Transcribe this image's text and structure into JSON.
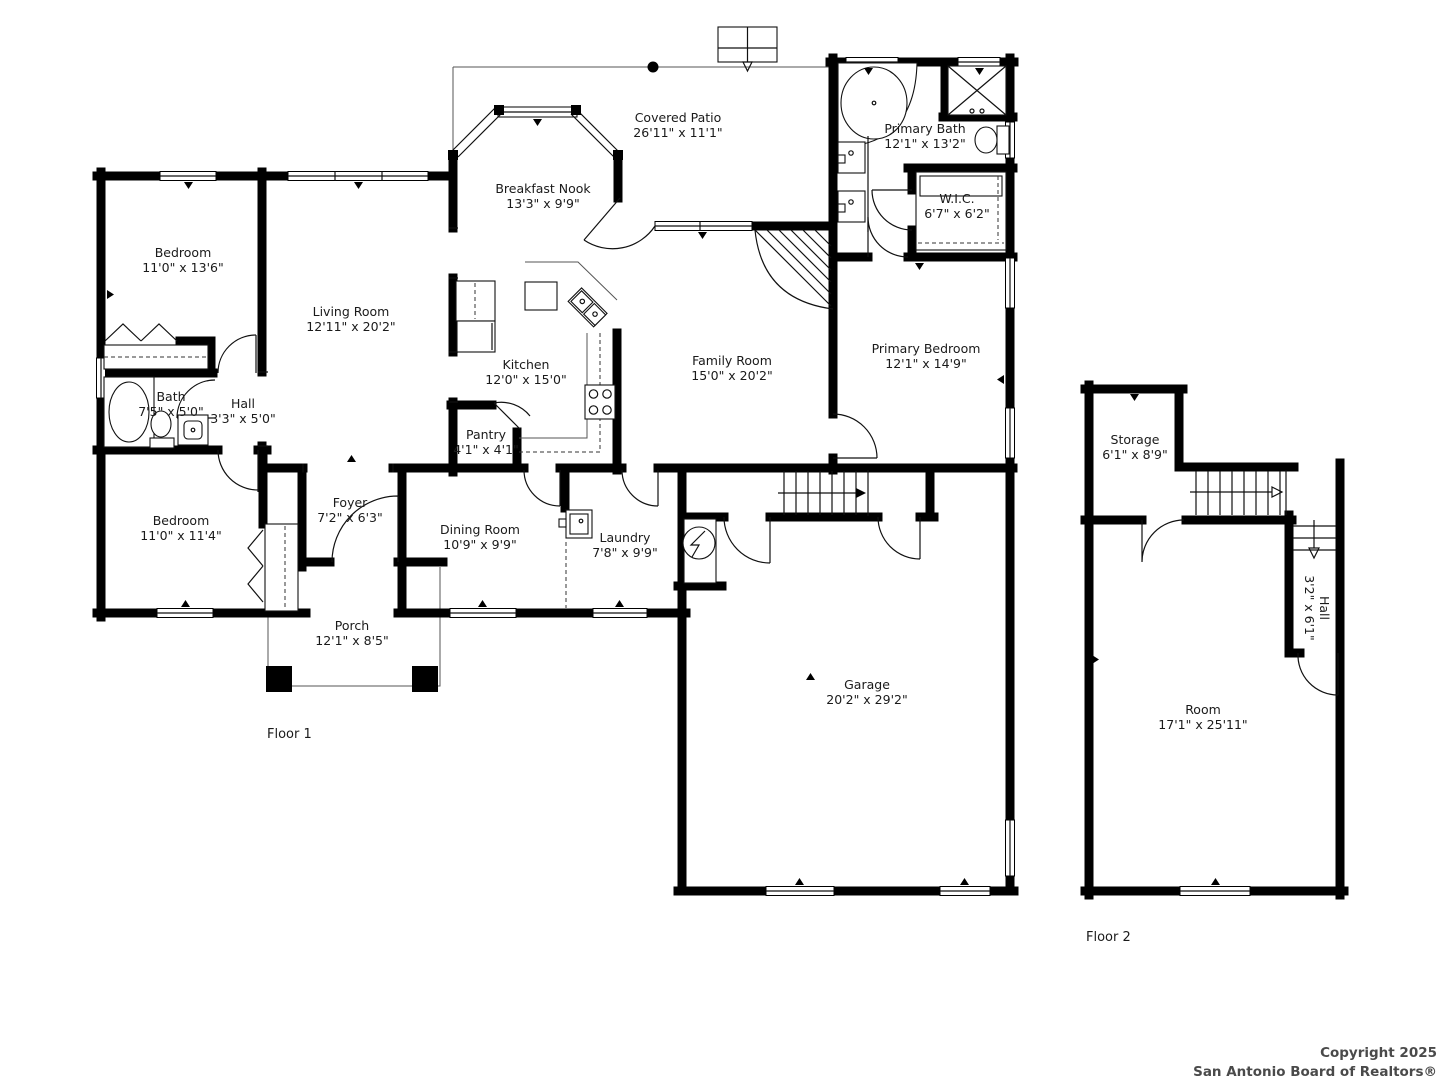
{
  "floors": {
    "floor1_label": "Floor 1",
    "floor2_label": "Floor 2"
  },
  "copyright": {
    "line1": "Copyright 2025",
    "line2": "San Antonio Board of Realtors®"
  },
  "rooms": [
    {
      "name": "Covered Patio",
      "dims": "26'11\" x 11'1\""
    },
    {
      "name": "Breakfast Nook",
      "dims": "13'3\" x 9'9\""
    },
    {
      "name": "Primary Bath",
      "dims": "12'1\" x 13'2\""
    },
    {
      "name": "W.I.C.",
      "dims": "6'7\" x 6'2\""
    },
    {
      "name": "Bedroom",
      "dims": "11'0\" x 13'6\""
    },
    {
      "name": "Living Room",
      "dims": "12'11\" x 20'2\""
    },
    {
      "name": "Kitchen",
      "dims": "12'0\" x 15'0\""
    },
    {
      "name": "Family Room",
      "dims": "15'0\" x 20'2\""
    },
    {
      "name": "Primary Bedroom",
      "dims": "12'1\" x 14'9\""
    },
    {
      "name": "Bath",
      "dims": "7'5\" x 5'0\""
    },
    {
      "name": "Hall",
      "dims": "3'3\" x 5'0\""
    },
    {
      "name": "Pantry",
      "dims": "4'1\" x 4'1\""
    },
    {
      "name": "Bedroom",
      "dims": "11'0\" x 11'4\""
    },
    {
      "name": "Foyer",
      "dims": "7'2\" x 6'3\""
    },
    {
      "name": "Dining Room",
      "dims": "10'9\" x 9'9\""
    },
    {
      "name": "Laundry",
      "dims": "7'8\" x 9'9\""
    },
    {
      "name": "Porch",
      "dims": "12'1\" x 8'5\""
    },
    {
      "name": "Garage",
      "dims": "20'2\" x 29'2\""
    },
    {
      "name": "Storage",
      "dims": "6'1\" x 8'9\""
    },
    {
      "name": "Hall",
      "dims": "3'2\" x 6'1\""
    },
    {
      "name": "Room",
      "dims": "17'1\" x 25'11\""
    }
  ]
}
